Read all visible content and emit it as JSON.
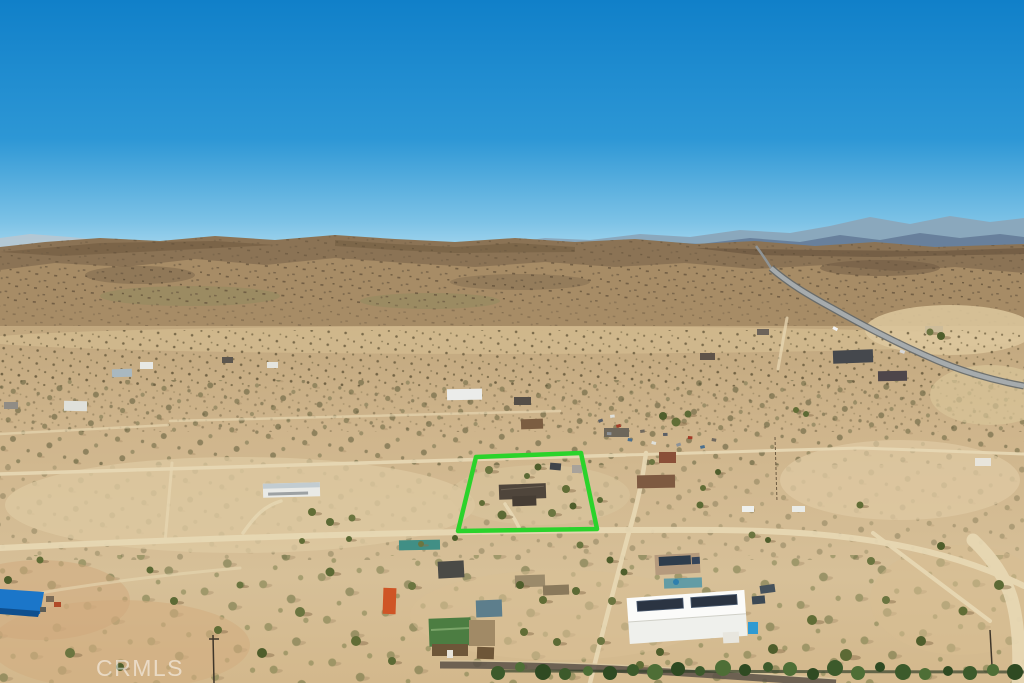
{
  "photo": {
    "kind": "aerial drone photograph",
    "scene": "high-desert residential valley with rocky hills and distant blue mountains; subject parcel outlined in green; scattered homes, dirt roads, a curving paved highway, and a white solar-roof warehouse in the foreground",
    "watermark": "CRMLS"
  },
  "colors": {
    "sky_top": "#1080c9",
    "sky_mid": "#2d97d5",
    "sky_horizon": "#a6d7ee",
    "far_ridge": "#8aa8bd",
    "near_ridge": "#68809c",
    "hills_dark": "#8b7355",
    "hills_light": "#a78c66",
    "desert_dark": "#c1a77e",
    "desert_light": "#d7c098",
    "dirt_road": "#e8d8b4",
    "paved_road": "#a6abad",
    "boundary_green": "#2bd32b",
    "watermark": "rgba(255,255,255,0.52)"
  }
}
